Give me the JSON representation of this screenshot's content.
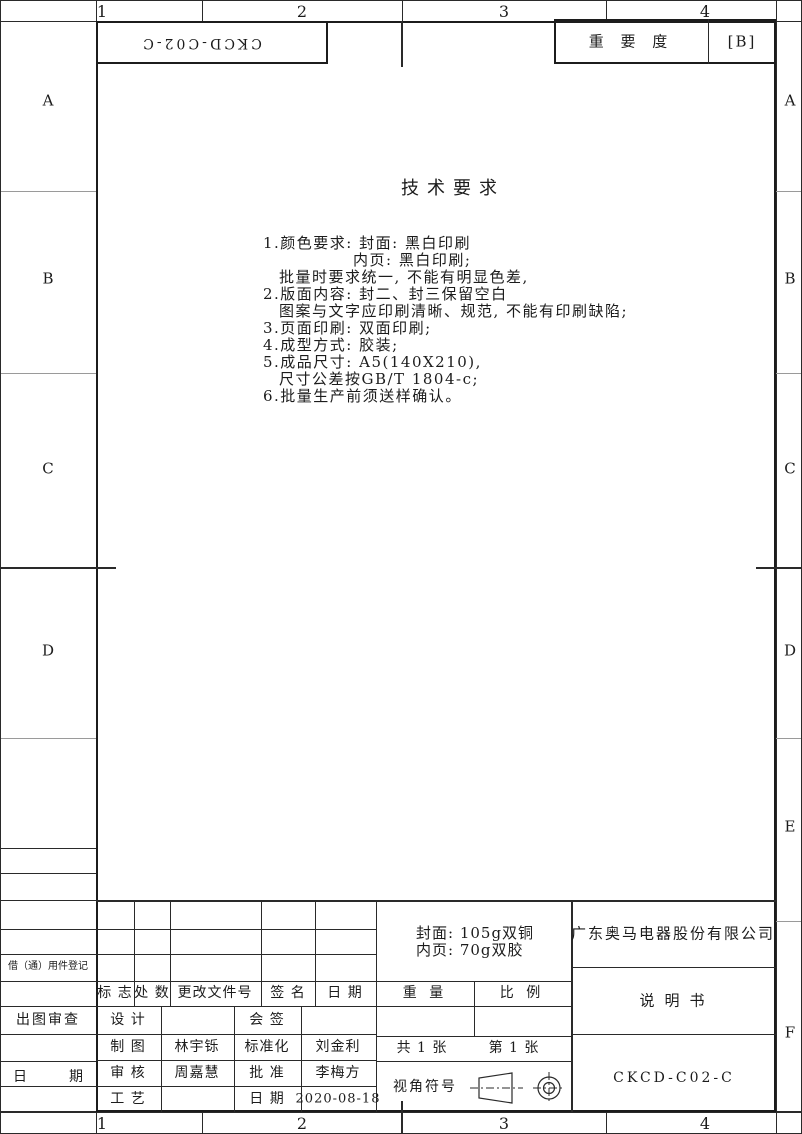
{
  "zones": {
    "top": [
      "1",
      "2",
      "3",
      "4"
    ],
    "bottom": [
      "1",
      "2",
      "3",
      "4"
    ],
    "left": [
      "A",
      "B",
      "C",
      "D"
    ],
    "right": [
      "A",
      "B",
      "C",
      "D",
      "E",
      "F"
    ]
  },
  "header": {
    "doc_number_rotated": "CKCD-C02-C",
    "importance_label": "重 要 度",
    "importance_value": "[B]"
  },
  "tech": {
    "title": "技术要求",
    "lines": [
      "1.颜色要求: 封面: 黑白印刷",
      "内页: 黑白印刷;",
      "批量时要求统一, 不能有明显色差,",
      "2.版面内容: 封二、封三保留空白",
      "图案与文字应印刷清晰、规范, 不能有印刷缺陷;",
      "3.页面印刷: 双面印刷;",
      "4.成型方式: 胶装;",
      "5.成品尺寸: A5(140X210),",
      "尺寸公差按GB/T 1804-c;",
      "6.批量生产前须送样确认。"
    ]
  },
  "left_column": {
    "borrow_register": "借（通）用件登记",
    "plot_review": "出图审查",
    "date_left": "日",
    "date_right": "期"
  },
  "revision_table": {
    "headers": [
      "标 志",
      "处 数",
      "更改文件号",
      "签  名",
      "日  期"
    ]
  },
  "signature_table": {
    "rows": [
      {
        "c1": "设 计",
        "v1": "",
        "c2": "会 签",
        "v2": ""
      },
      {
        "c1": "制 图",
        "v1": "林宇铄",
        "c2": "标准化",
        "v2": "刘金利"
      },
      {
        "c1": "审 核",
        "v1": "周嘉慧",
        "c2": "批 准",
        "v2": "李梅方"
      },
      {
        "c1": "工 艺",
        "v1": "",
        "c2": "日 期",
        "v2": "2020-08-18"
      }
    ]
  },
  "material_note": {
    "line1": "封面: 105g双铜",
    "line2": "内页: 70g双胶"
  },
  "weight_label": "重 量",
  "scale_label": "比 例",
  "sheets": {
    "total": "共 1 张",
    "number": "第 1 张"
  },
  "view_symbol_label": "视角符号",
  "company": "广东奥马电器股份有限公司",
  "doc_title": "说明书",
  "drawing_number": "CKCD-C02-C",
  "colors": {
    "line": "#2a2a2a",
    "ink": "#1c1c1c",
    "paper": "#ffffff"
  }
}
